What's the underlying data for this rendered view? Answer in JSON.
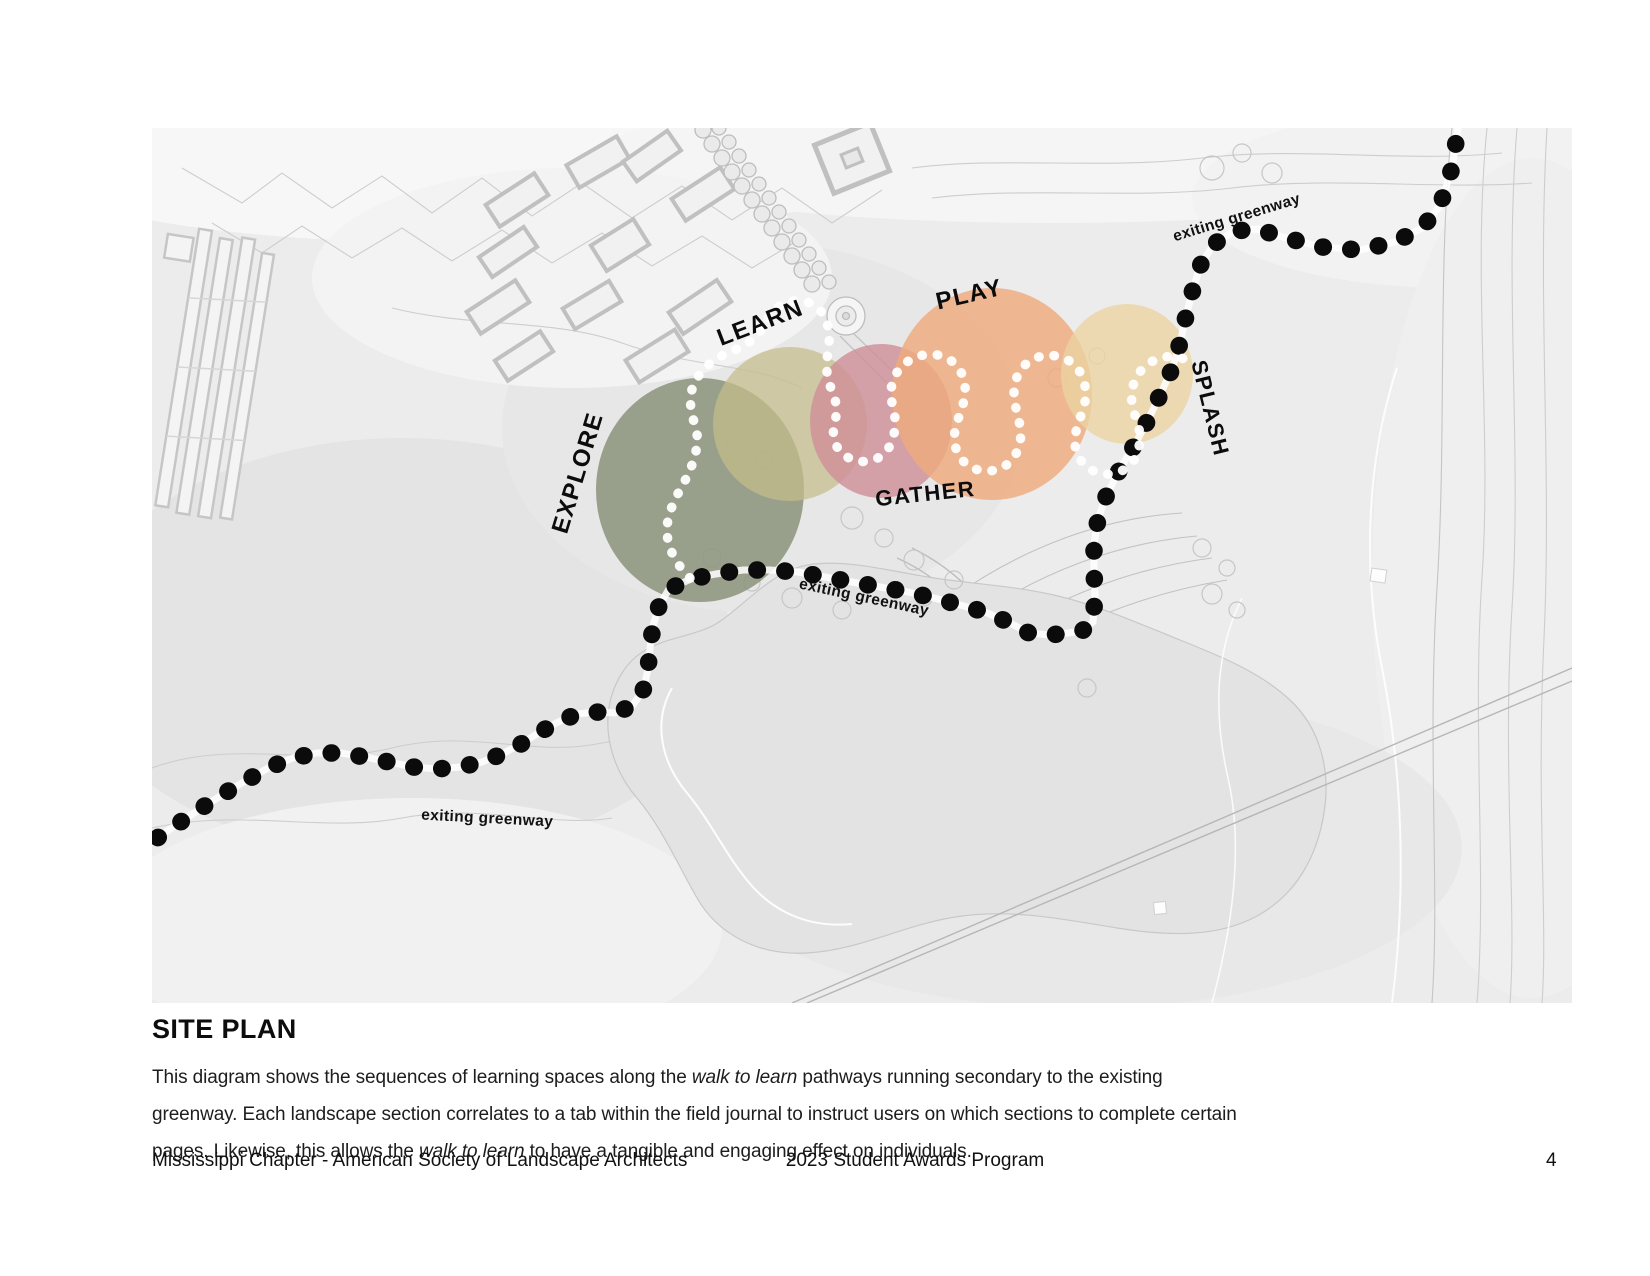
{
  "map": {
    "zones": [
      {
        "id": "explore",
        "label": "EXPLORE",
        "color": "#8d967f"
      },
      {
        "id": "learn",
        "label": "LEARN",
        "color": "#c6bd8a"
      },
      {
        "id": "gather",
        "label": "GATHER",
        "color": "#d08f99"
      },
      {
        "id": "play",
        "label": "PLAY",
        "color": "#eeab7e"
      },
      {
        "id": "splash",
        "label": "SPLASH",
        "color": "#ecd3a2"
      }
    ],
    "greenway_label": "exiting greenway",
    "path_colors": {
      "existing_greenway_dots": "#0b0b0b",
      "walk_to_learn_dots": "#ffffff"
    }
  },
  "caption": {
    "title": "SITE PLAN",
    "line1_a": "This diagram shows the sequences of learning spaces along the ",
    "line1_i": "walk to learn",
    "line1_b": " pathways running secondary to the existing",
    "line2": "greenway. Each landscape section correlates to a tab within the field journal to instruct users on which sections to complete certain",
    "line3_a": "pages. Likewise, this allows the ",
    "line3_i": "walk to learn",
    "line3_b": " to have a tangible and engaging effect on individuals."
  },
  "footer": {
    "left": "Mississippi Chapter - American Society of Landscape Architects",
    "center": "2023 Student Awards Program",
    "page_number": "4"
  }
}
